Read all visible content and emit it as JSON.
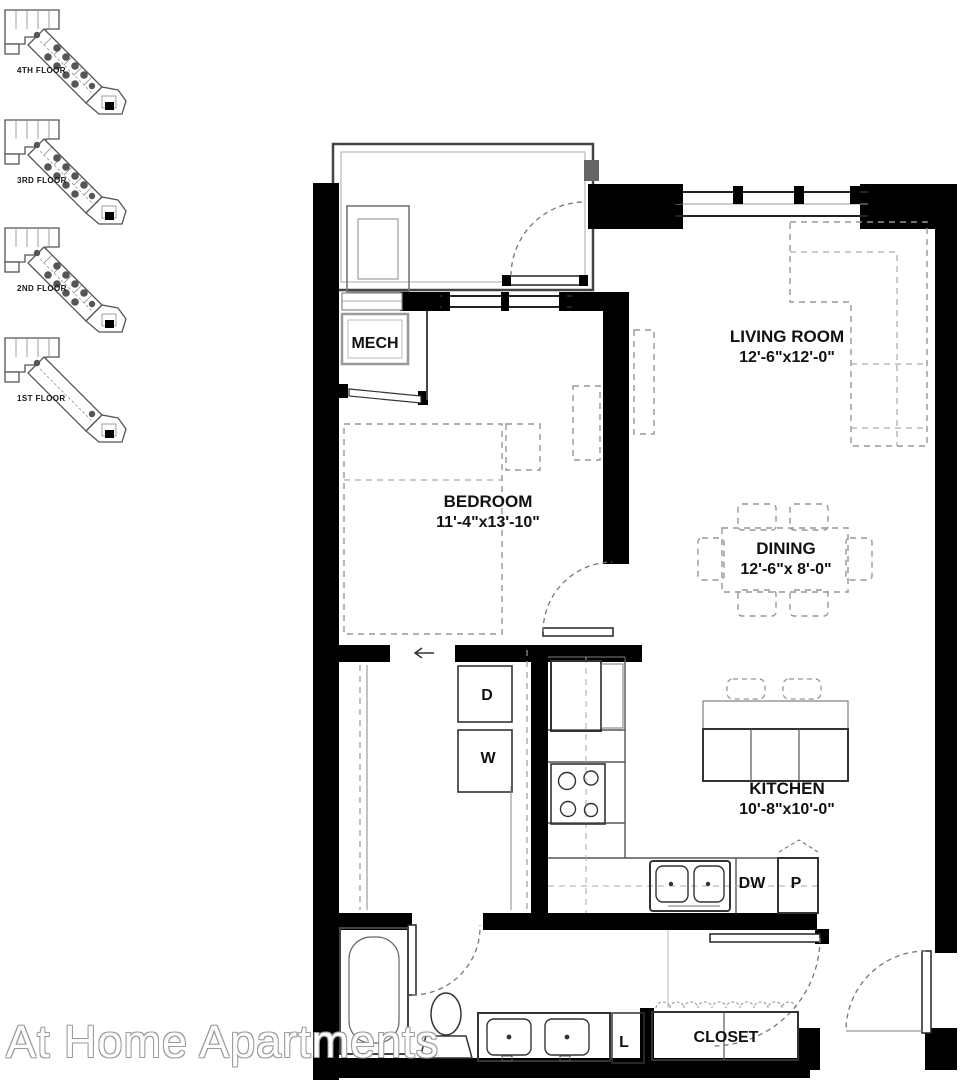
{
  "watermark": "At Home Apartments",
  "key_plans": {
    "floors": [
      {
        "label": "4TH FLOOR"
      },
      {
        "label": "3RD FLOOR"
      },
      {
        "label": "2ND FLOOR"
      },
      {
        "label": "1ST FLOOR"
      }
    ]
  },
  "rooms": {
    "living": {
      "name": "LIVING ROOM",
      "dims": "12'-6\"x12'-0\""
    },
    "bedroom": {
      "name": "BEDROOM",
      "dims": "11'-4\"x13'-10\""
    },
    "dining": {
      "name": "DINING",
      "dims": "12'-6\"x 8'-0\""
    },
    "kitchen": {
      "name": "KITCHEN",
      "dims": "10'-8\"x10'-0\""
    },
    "mech": {
      "name": "MECH"
    },
    "closet": {
      "name": "CLOSET"
    }
  },
  "fixtures": {
    "dryer": "D",
    "washer": "W",
    "dishwasher": "DW",
    "pantry": "P",
    "linen": "L"
  },
  "colors": {
    "wall": "#000000",
    "outline": "#4d4d4d",
    "furniture_dash": "#979797",
    "watermark_outline": "#9b9b9b",
    "background": "#ffffff"
  }
}
